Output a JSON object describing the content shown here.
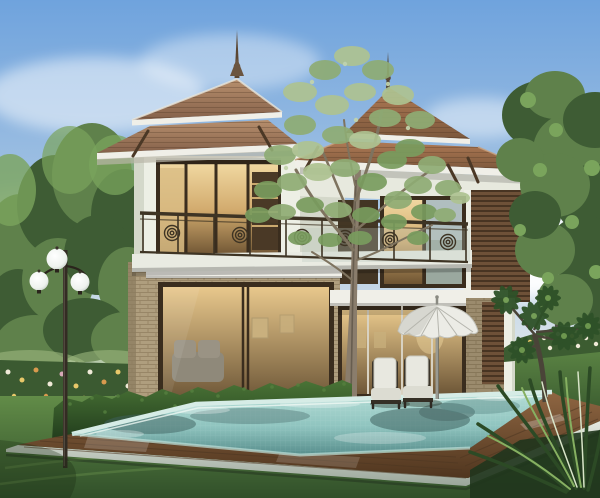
{
  "scene": {
    "description": "3D architectural rendering of a two-storey tropical villa with tiered hip roofs and a finial spire, warm glowing floor-to-ceiling windows, a wrap-around balcony with ornamental circle railing, tan brick lower walls, wooden louver panels, a trimmed hedge, a garden lamp post with three white globes, a turquoise swimming pool framed by a wooden deck and pale stone coping, a white patio umbrella with two white chairs, surrounding lawn, flower beds, background trees, a slender tree growing in front of the house, and a spiky foreground plant at bottom right.",
    "objects": [
      "sky",
      "clouds",
      "background-trees",
      "villa",
      "tiered-hip-roofs",
      "roof-spires",
      "balcony-railing",
      "glowing-windows",
      "brick-walls",
      "louver-panels",
      "lamp-post-three-globes",
      "center-tree",
      "hedge",
      "flower-beds",
      "lawn",
      "swimming-pool",
      "wooden-deck",
      "stone-coping",
      "patio-umbrella",
      "two-patio-chairs",
      "plumeria-tree",
      "spiky-plant"
    ]
  },
  "palette": {
    "sky-top": "#6fa3dd",
    "sky-mid": "#aac7e4",
    "sky-low": "#dde7ec",
    "cloud": "#ffffff",
    "tree-dark": "#3e5c34",
    "tree-mid": "#5f814b",
    "tree-light": "#7aa45c",
    "tree-pale": "#9cb87e",
    "center-foliage-light": "#aec391",
    "center-foliage-mid": "#8fac74",
    "center-foliage-dark": "#799c5e",
    "trunk-light": "#8d8070",
    "trunk-dark": "#6b614f",
    "roof-light": "#b78f6d",
    "roof-dark": "#85614a",
    "roof-red": "#b07a55",
    "roof-red-dark": "#7c583c",
    "fascia": "#f0efe8",
    "soffit": "#d6d5c9",
    "wall": "#edefe5",
    "wall-shadow": "#d4d8ca",
    "brick": "#bfae8c",
    "brick-line": "#a3916f",
    "brick-dark": "#8a7a5e",
    "frame": "#3a2d1e",
    "glass-warm": "#e2c288",
    "glass-deep": "#6f5634",
    "glass-cool": "#9aa89f",
    "louver": "#6e5138",
    "louver-line": "#3f2c1d",
    "railing": "#3e3424",
    "bracket": "#4b3826",
    "hedge-light": "#4a7436",
    "hedge-dark": "#1d371a",
    "lawn-light": "#628c48",
    "lawn-dark": "#31502a",
    "flower-white": "#f0ead8",
    "flower-yellow": "#e8c86a",
    "flower-orange": "#d89a4e",
    "flower-pink": "#d8a8b8",
    "pool-far": "#b4ddd6",
    "pool-mid": "#8fc4bf",
    "pool-near": "#578e8c",
    "pool-mosaic": "#cfe9e2",
    "deck-light": "#8f6642",
    "deck-dark": "#50361f",
    "plank": "#4e3722",
    "coping-light": "#e6eae2",
    "coping-dark": "#9aa69a",
    "umbrella": "#ecece6",
    "umbrella-shade": "#c6c6be",
    "umbrella-pole": "#9a9a92",
    "chair-cushion": "#e8e8e0",
    "chair-frame": "#2e2a22",
    "lamp-globe": "#f4f6f4",
    "lamp-pole": "#332c23",
    "water-reflection": "#3e5f5e",
    "mulch": "#20351d"
  }
}
